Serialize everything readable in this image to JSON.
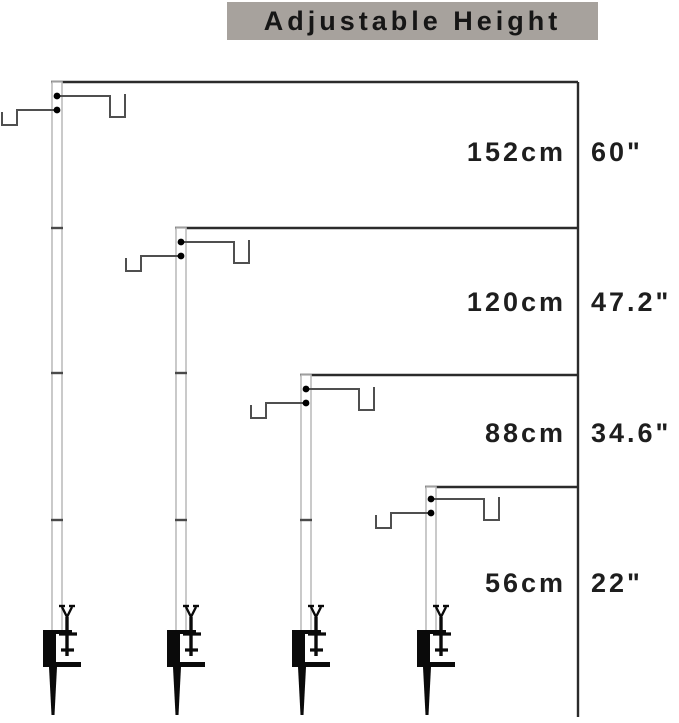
{
  "title": "Adjustable Height",
  "rows": [
    {
      "cm": "152cm",
      "inch": "60\""
    },
    {
      "cm": "120cm",
      "inch": "47.2\""
    },
    {
      "cm": "88cm",
      "inch": "34.6\""
    },
    {
      "cm": "56cm",
      "inch": "22\""
    }
  ],
  "colors": {
    "title_background": "#a7a29d",
    "text": "#1e1e1e",
    "pole_outline": "#bcbcbc",
    "bracket_line": "#2b2b2b",
    "arm_line": "#4f4f4f",
    "hardware_black": "#0a0a0a"
  }
}
